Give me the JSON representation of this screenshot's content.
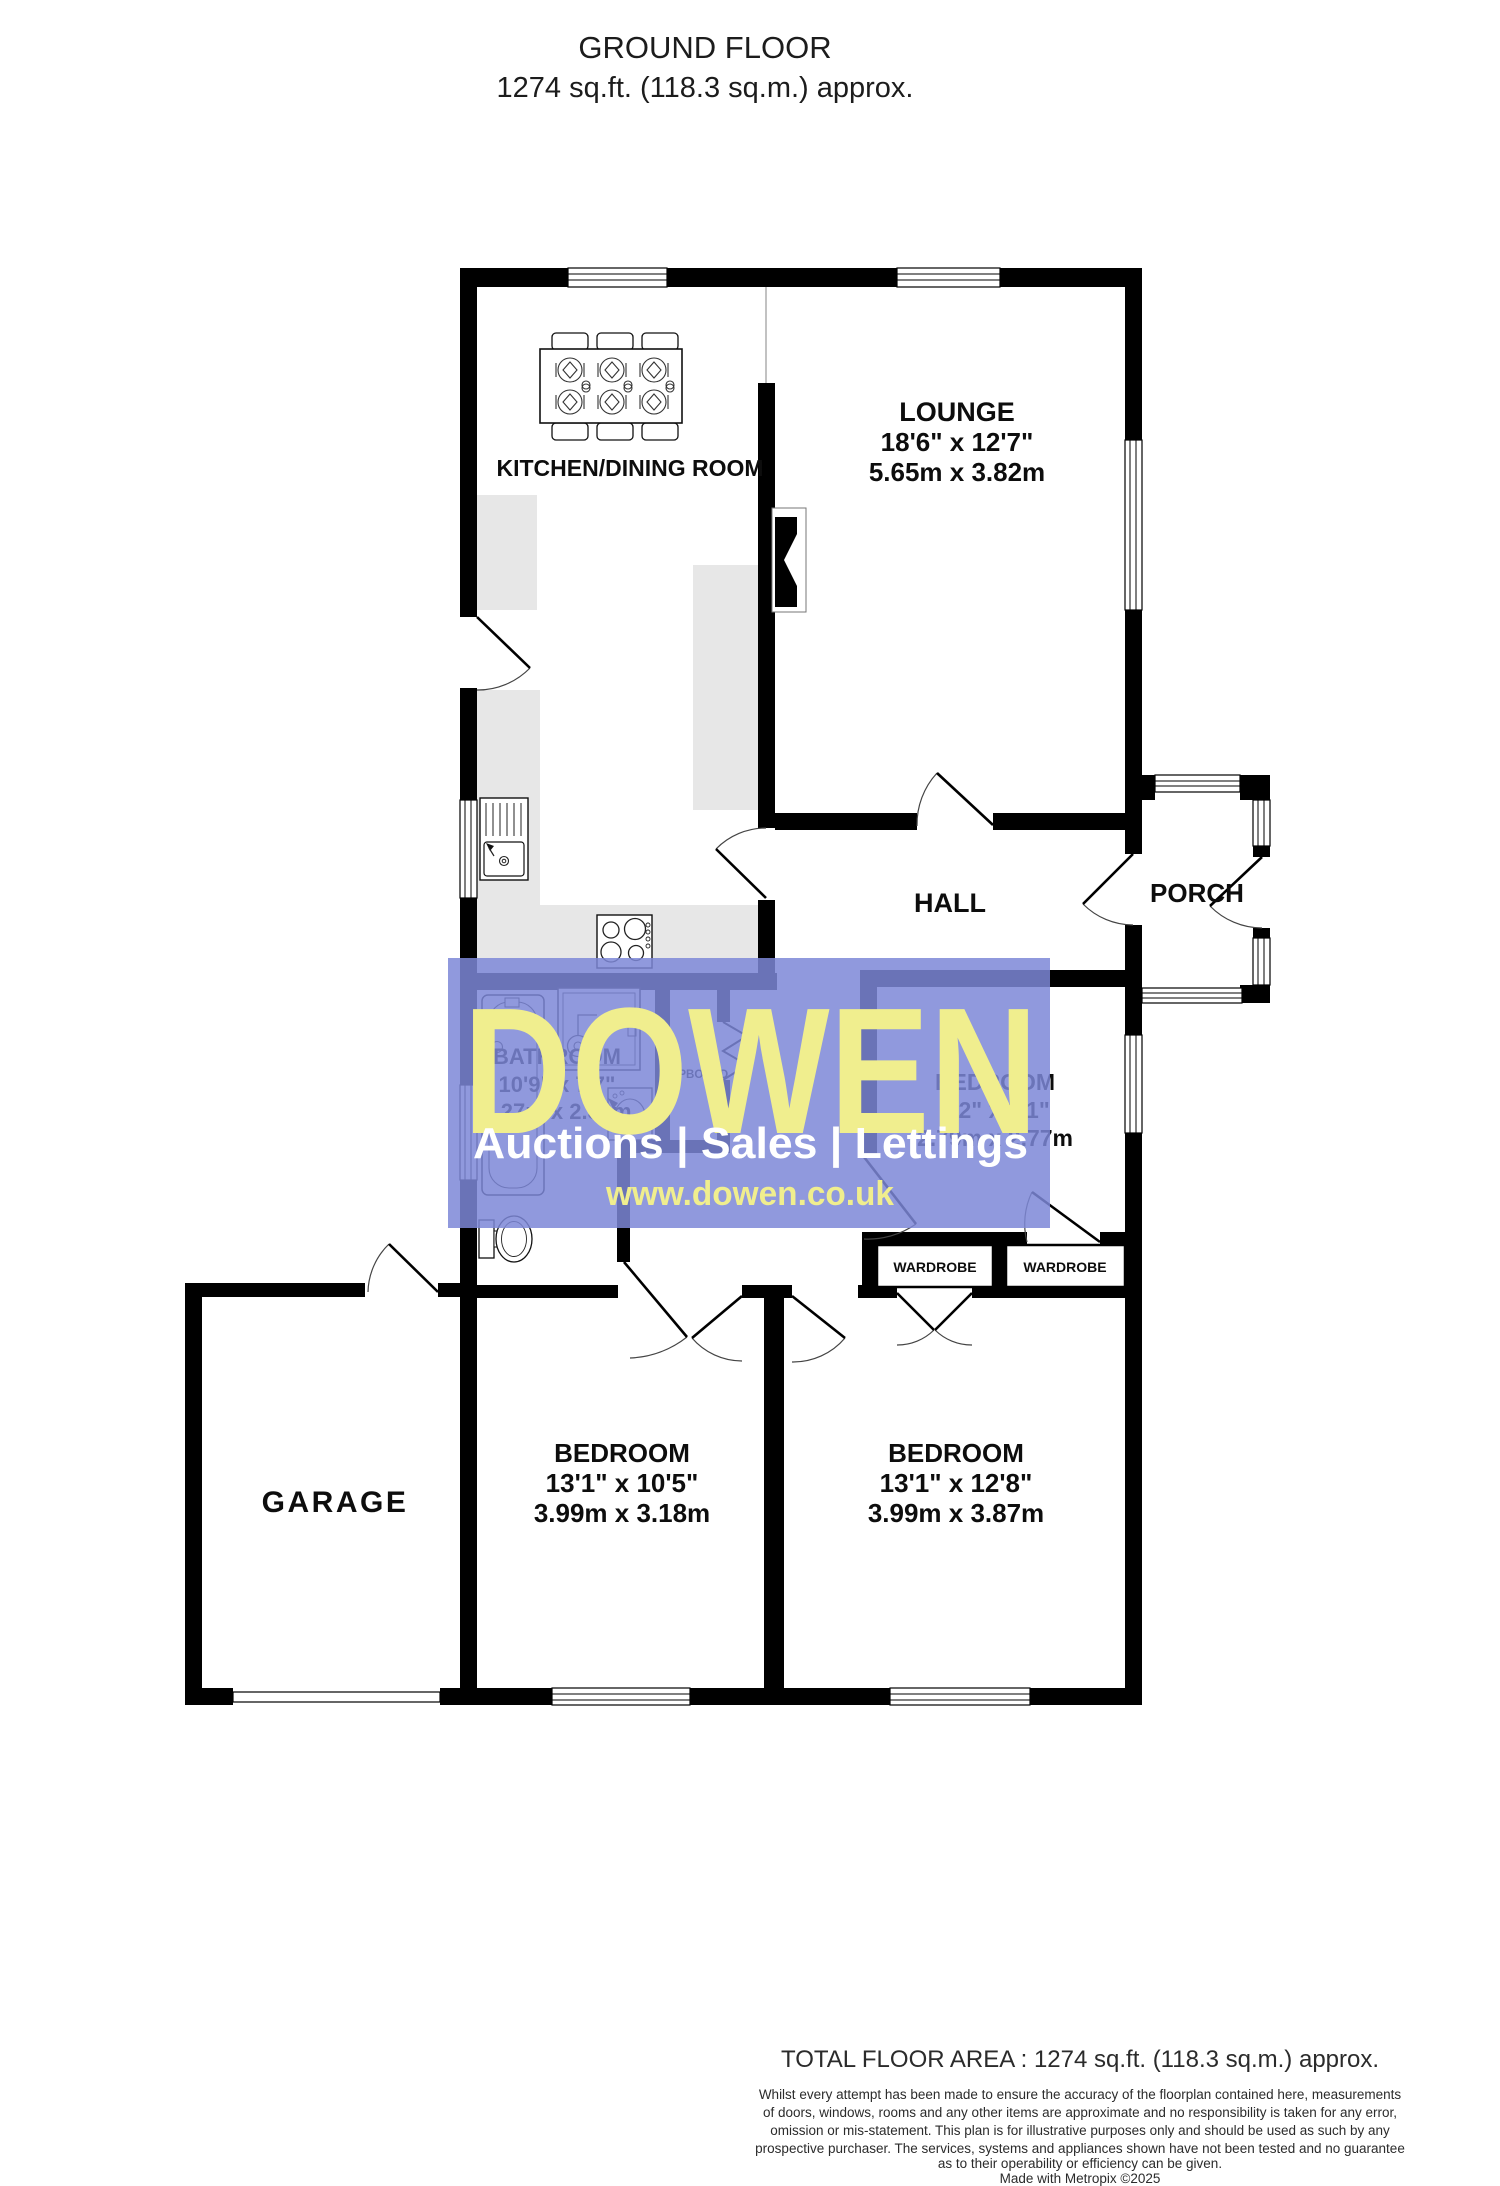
{
  "title": {
    "line1": "GROUND FLOOR",
    "line2": "1274 sq.ft. (118.3 sq.m.) approx."
  },
  "rooms": {
    "kitchen_dining": {
      "name": "KITCHEN/DINING ROOM"
    },
    "lounge": {
      "name": "LOUNGE",
      "size_imperial": "18'6\" x 12'7\"",
      "size_metric": "5.65m x 3.82m"
    },
    "hall": {
      "name": "HALL"
    },
    "porch": {
      "name": "PORCH"
    },
    "bathroom": {
      "name": "BATHROOM",
      "size_imperial": "10'9\" x 7'7\"",
      "size_metric": "3.27m x 2.32m"
    },
    "cupboard": {
      "name": "CUPBOARD"
    },
    "bedroom1": {
      "name": "BEDROOM",
      "size_imperial": "9'2\" x 9'1\"",
      "size_metric": "2.79m x 2.77m"
    },
    "wardrobe_left": {
      "name": "WARDROBE"
    },
    "wardrobe_right": {
      "name": "WARDROBE"
    },
    "bedroom2": {
      "name": "BEDROOM",
      "size_imperial": "13'1\" x 10'5\"",
      "size_metric": "3.99m x 3.18m"
    },
    "bedroom3": {
      "name": "BEDROOM",
      "size_imperial": "13'1\" x 12'8\"",
      "size_metric": "3.99m x 3.87m"
    },
    "garage": {
      "name": "GARAGE"
    }
  },
  "watermark": {
    "brand": "DOWEN",
    "tagline": "Auctions | Sales | Lettings",
    "url": "www.dowen.co.uk",
    "overlay_color": "#7d87d7",
    "brand_color": "#f0ee8e",
    "tagline_color": "#ffffff"
  },
  "footer": {
    "total_area": "TOTAL FLOOR AREA : 1274 sq.ft. (118.3 sq.m.) approx.",
    "disclaimer_lines": [
      "Whilst every attempt has been made to ensure the accuracy of the floorplan contained here, measurements",
      "of doors, windows, rooms and any other items are approximate and no responsibility is taken for any error,",
      "omission or mis-statement. This plan is for illustrative purposes only and should be used as such by any",
      "prospective purchaser. The services, systems and appliances shown have not been tested and no guarantee",
      "as to their operability or efficiency can be given."
    ],
    "credit": "Made with Metropix ©2025"
  }
}
